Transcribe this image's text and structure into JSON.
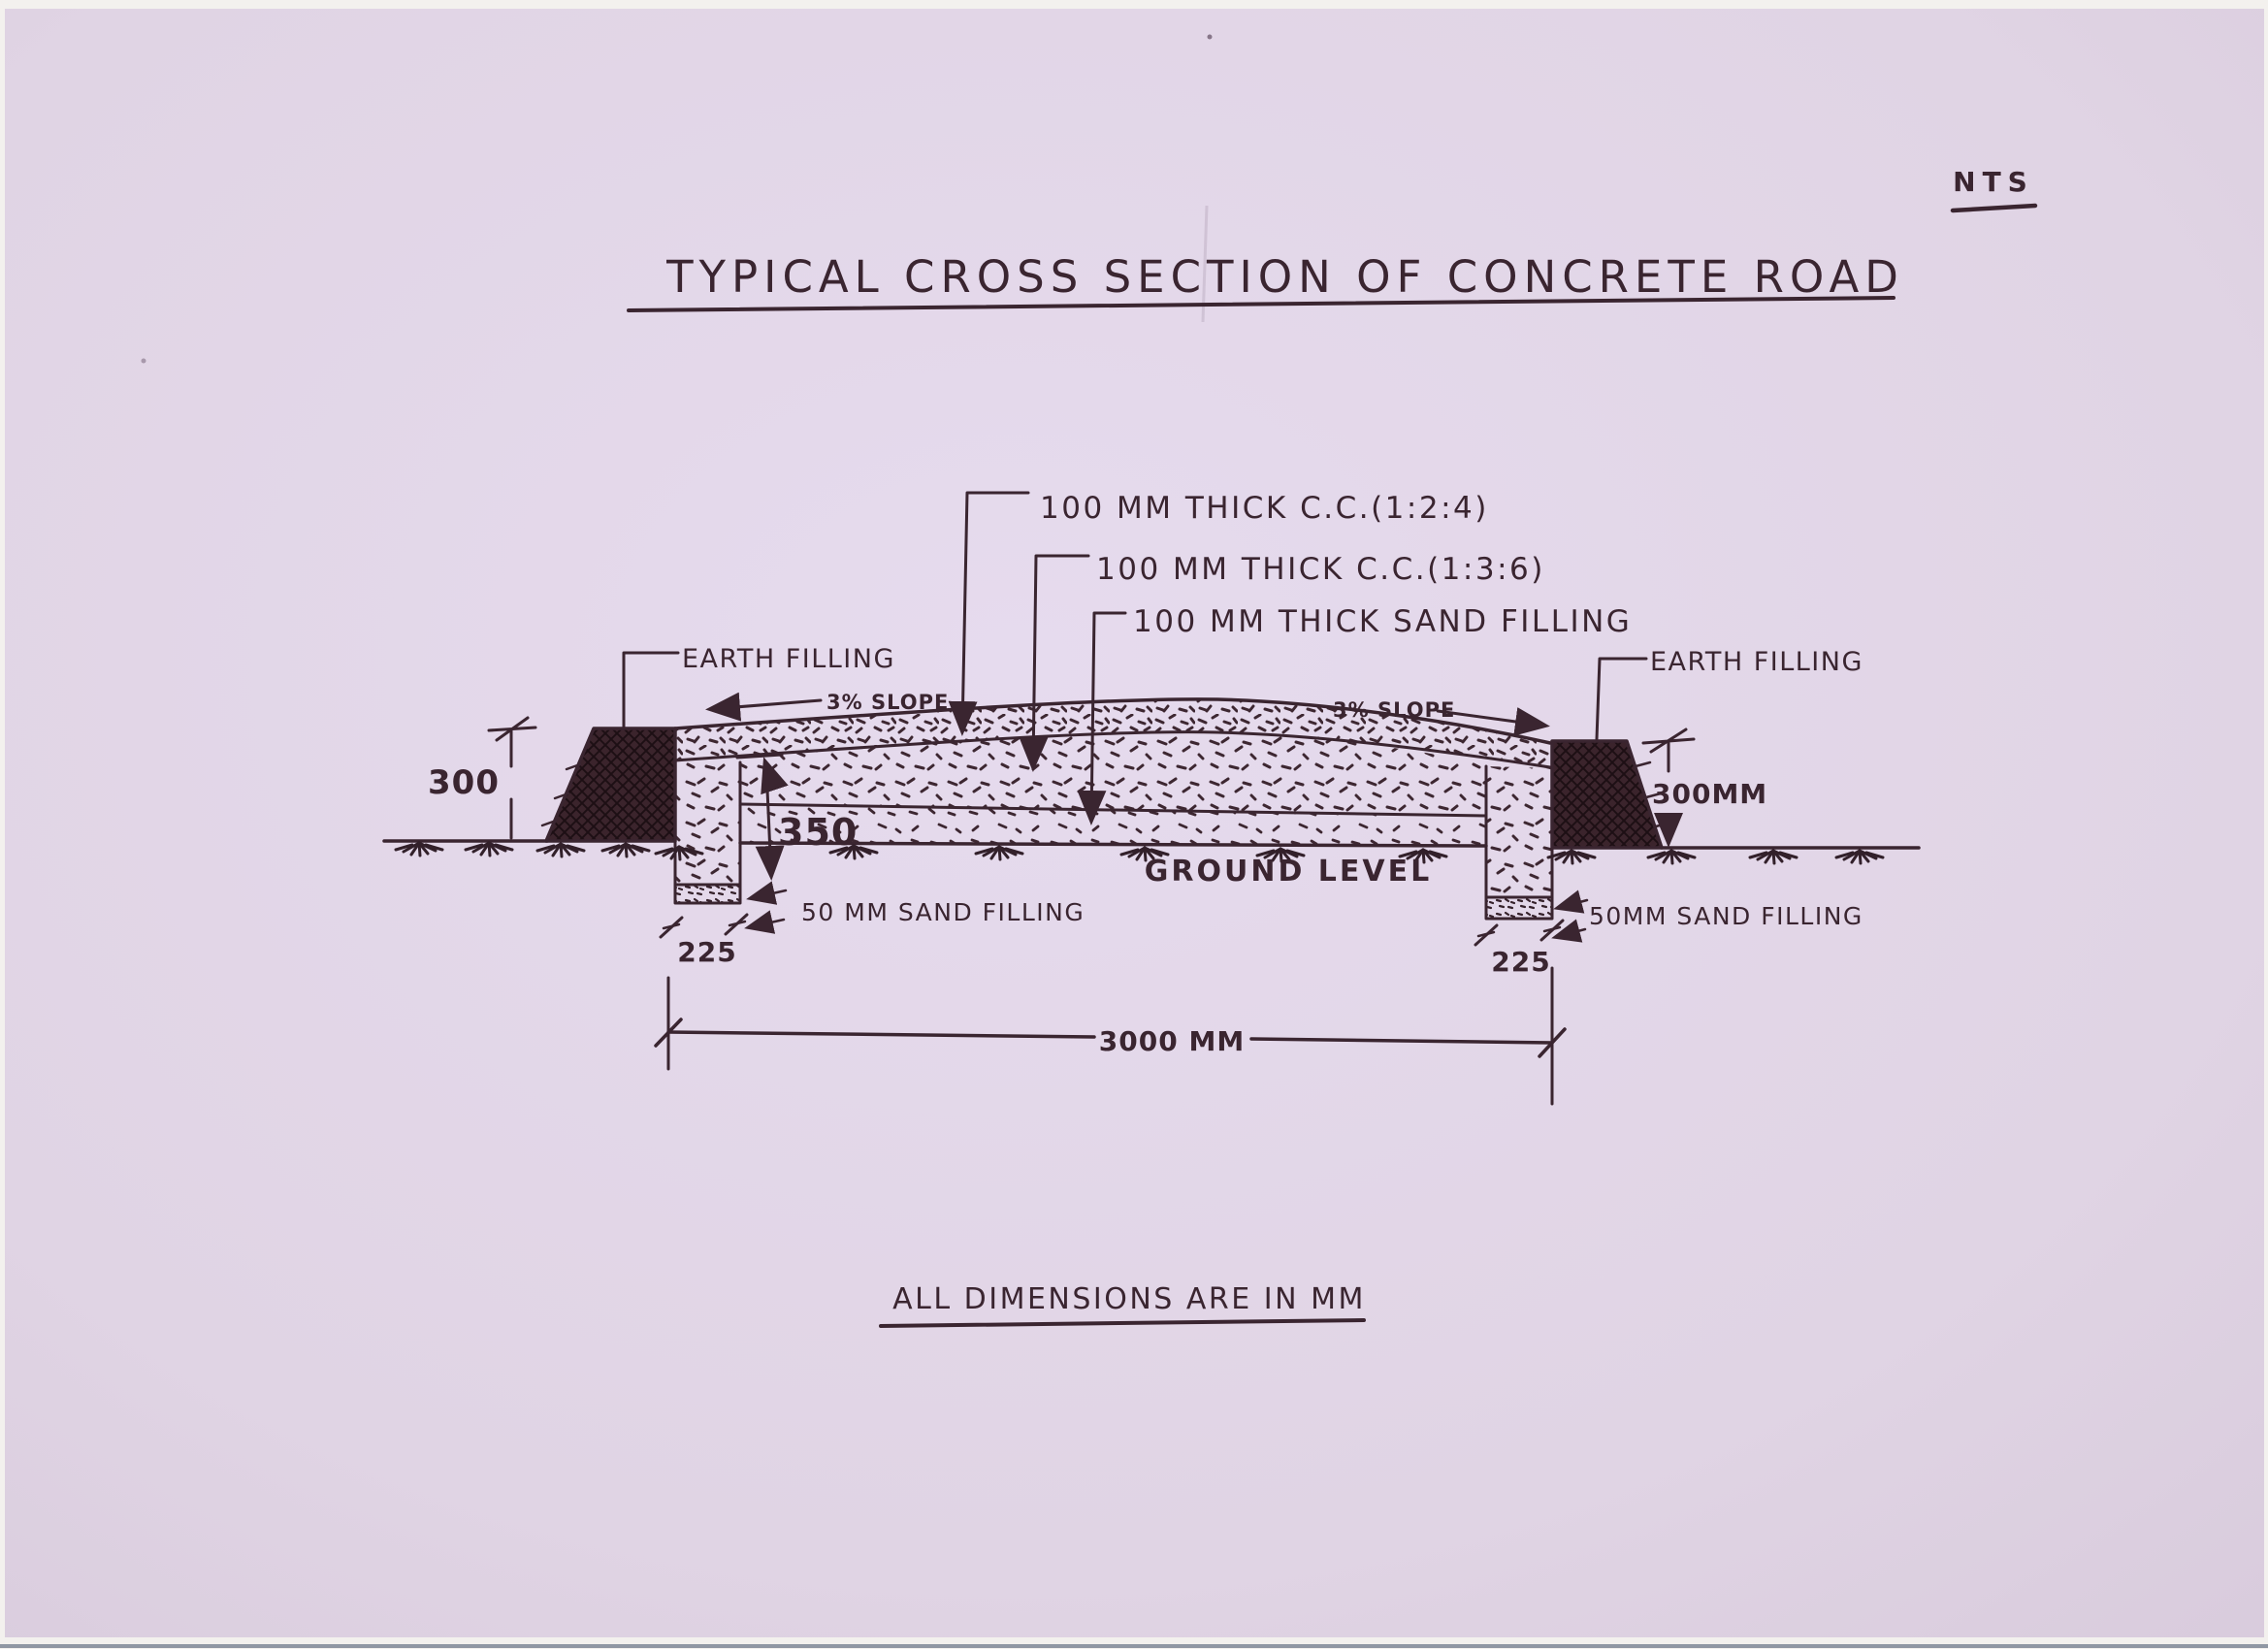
{
  "page": {
    "scale_note": "NTS",
    "title": "TYPICAL CROSS SECTION OF CONCRETE ROAD",
    "footnote": "ALL DIMENSIONS ARE IN MM"
  },
  "callouts": {
    "layer1": "100 MM THICK C.C.(1:2:4)",
    "layer2": "100 MM THICK C.C.(1:3:6)",
    "layer3": "100 MM THICK SAND FILLING",
    "earth_filling_left": "EARTH FILLING",
    "earth_filling_right": "EARTH FILLING",
    "slope_left": "3% SLOPE",
    "slope_right": "3% SLOPE",
    "ground_level": "GROUND LEVEL",
    "sand_filling_left": "50 MM SAND FILLING",
    "sand_filling_right": "50MM SAND FILLING"
  },
  "dimensions": {
    "embankment_height_left": "300",
    "embankment_height_right": "300MM",
    "edge_depth": "350",
    "kerb_width_left": "225",
    "kerb_width_right": "225",
    "road_width": "3000 MM"
  },
  "colors": {
    "paper": "#e2d6e8",
    "ink": "#3a2530"
  }
}
